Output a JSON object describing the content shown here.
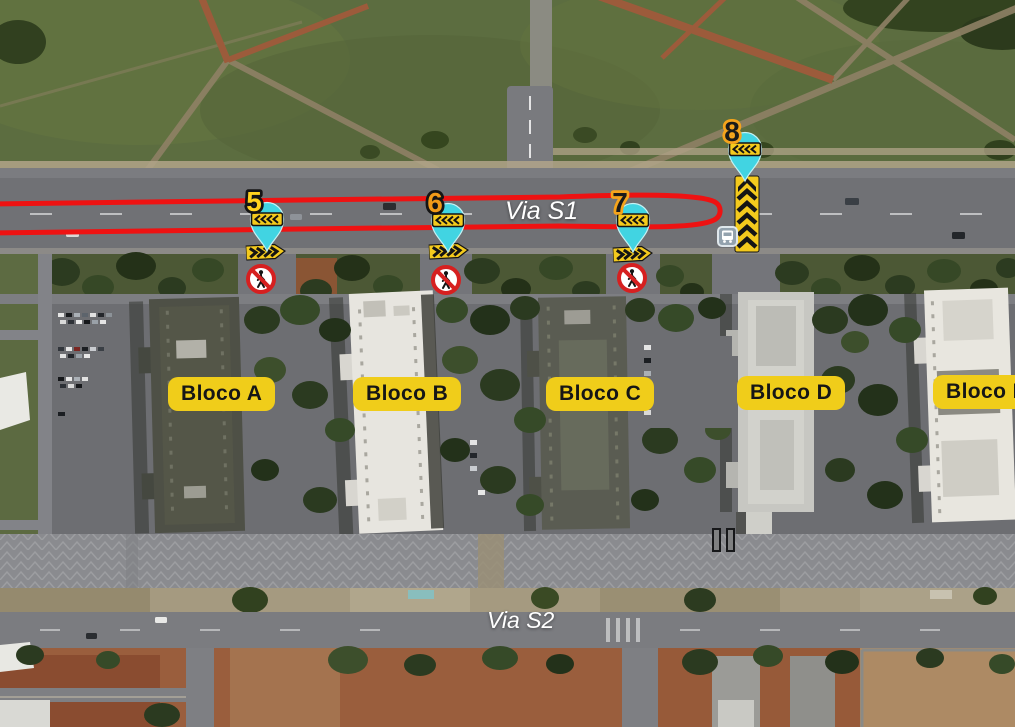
{
  "map_annotations": {
    "road_labels": {
      "via_s1": "Via S1",
      "via_s2": "Via S2"
    },
    "block_labels": [
      {
        "label": "Bloco A"
      },
      {
        "label": "Bloco B"
      },
      {
        "label": "Bloco C"
      },
      {
        "label": "Bloco D"
      },
      {
        "label": "Bloco E"
      }
    ],
    "markers": [
      {
        "number": "5",
        "icon": "teal-map-pin-with-left-chevrons"
      },
      {
        "number": "6",
        "icon": "teal-map-pin-with-left-chevrons"
      },
      {
        "number": "7",
        "icon": "teal-map-pin-with-left-chevrons"
      },
      {
        "number": "8",
        "icon": "teal-map-pin-with-left-chevrons"
      }
    ],
    "icons": {
      "crossing_arrow": "yellow-chevron-right-arrow",
      "barrier": "yellow-vertical-chevron-barrier",
      "prohibition": "no-pedestrians-sign",
      "bus_stop": "bus-stop-icon"
    },
    "colors": {
      "route_red": "#ee1212",
      "pin_teal": "#41d4e2",
      "chevron_yellow": "#f4ca1d",
      "label_yellow": "#f0cd1a",
      "prohibition_red": "#d62020"
    }
  }
}
